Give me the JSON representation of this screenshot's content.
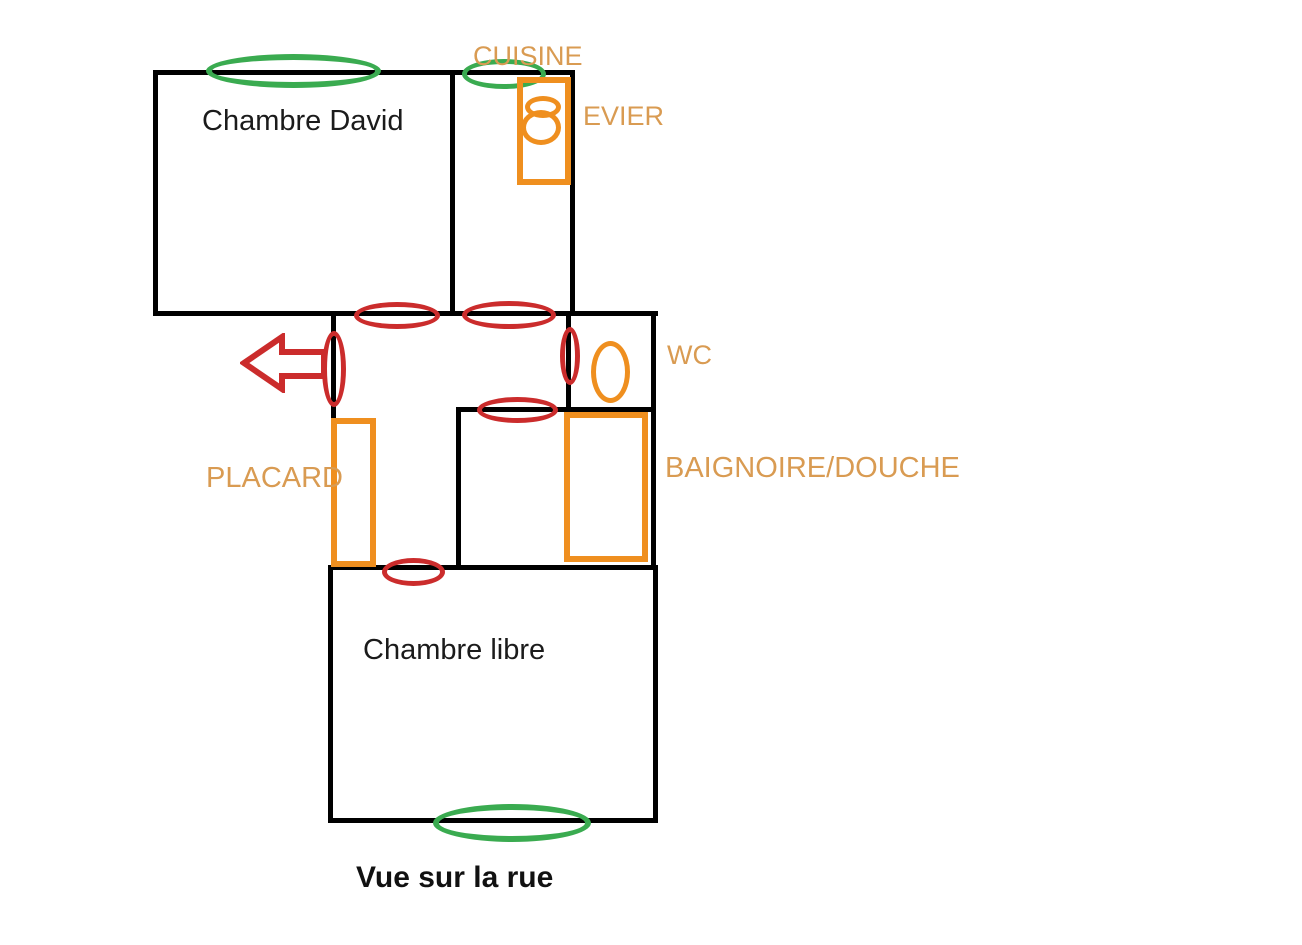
{
  "page": {
    "kind": "hand-drawn apartment floor plan",
    "background": "#ffffff",
    "width": 1302,
    "height": 945
  },
  "labels": {
    "chambre_david": "Chambre David",
    "cuisine": "CUISINE",
    "evier": "EVIER",
    "wc": "WC",
    "placard": "PLACARD",
    "baignoire_douche": "BAIGNOIRE/DOUCHE",
    "chambre_libre": "Chambre libre",
    "vue_sur_la_rue": "Vue sur la rue"
  },
  "colors": {
    "walls": "#000000",
    "window_markers": "#3aab50",
    "door_markers": "#cb2c2c",
    "exit_arrow": "#cb2c2c",
    "fixtures": "#ef8f1f",
    "fixture_labels": "#d99b52",
    "room_text": "#1b1b1b"
  },
  "markers": {
    "windows_green": [
      "window-chambre-david",
      "window-cuisine",
      "window-chambre-libre"
    ],
    "doors_red": [
      "door-chambre-david",
      "door-cuisine",
      "door-entrance",
      "door-wc",
      "door-baignoire",
      "door-chambre-libre"
    ],
    "fixtures_orange": [
      "evier-counter",
      "evier-basin-small",
      "evier-basin-round",
      "toilet-bowl",
      "placard-cabinet",
      "baignoire-tub"
    ],
    "arrow": "exit-arrow-left"
  }
}
